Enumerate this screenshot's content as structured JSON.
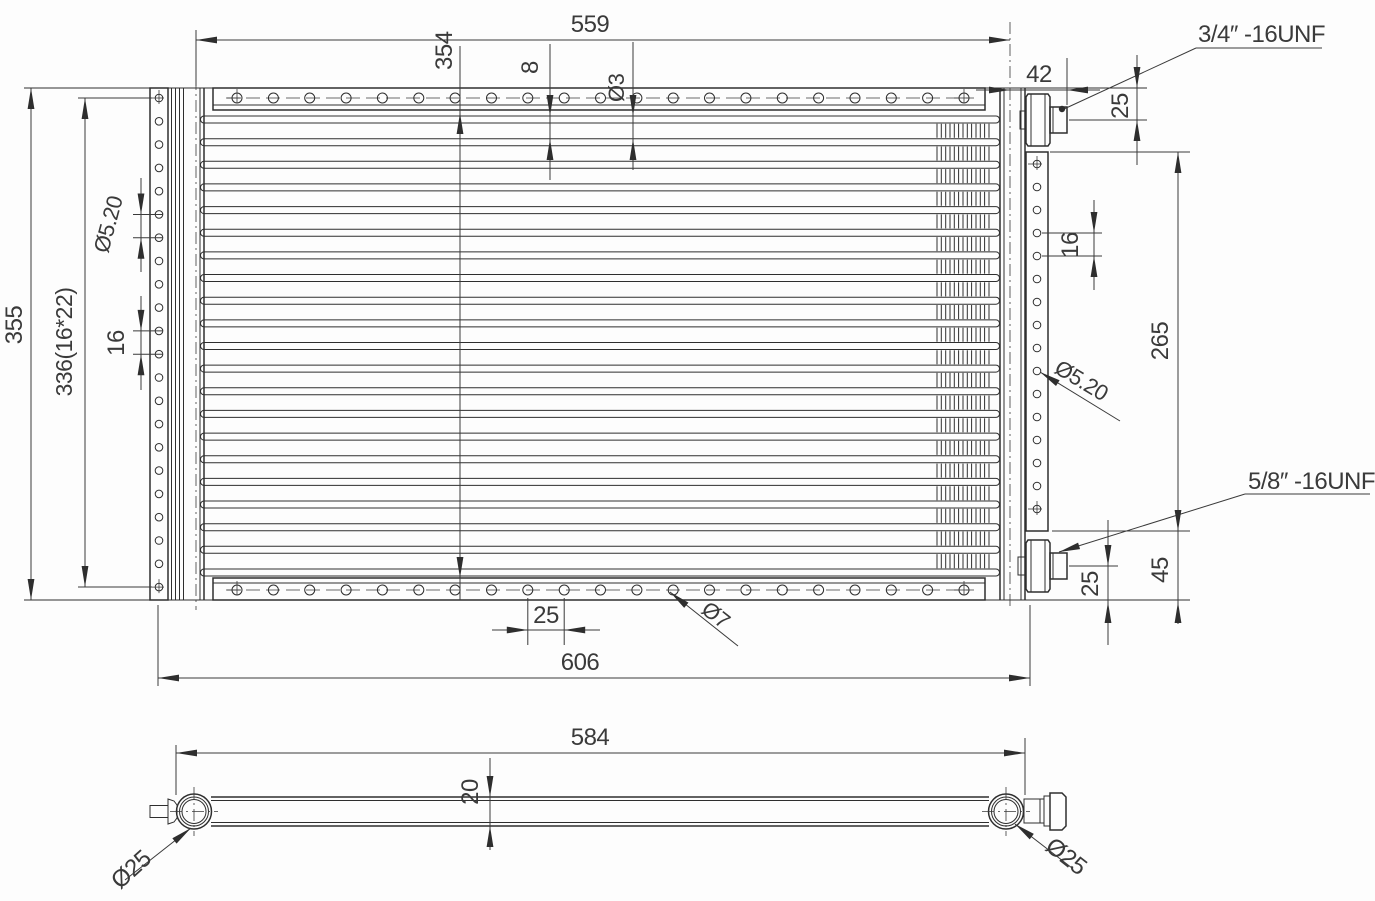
{
  "colors": {
    "background": "#fdfdfd",
    "line": "#2e2e2e",
    "dim_line": "#3a3a3a"
  },
  "front_view": {
    "dims": {
      "width_top": "559",
      "core_height": "354",
      "fin_pitch": "8",
      "tube_dia": "Ø3",
      "fitting_offset": "42",
      "top_fitting_center": "25",
      "right_hole_pitch": "16",
      "right_bracket_span": "265",
      "right_hole_dia": "Ø5.20",
      "bracket_to_bottom": "45",
      "bottom_fitting_center": "25",
      "height_overall": "355",
      "left_hole_span": "336(16*22)",
      "left_hole_dia": "Ø5.20",
      "left_hole_pitch": "16",
      "bottom_hole_pitch": "25",
      "bottom_hole_dia": "Ø7",
      "width_overall": "606"
    },
    "labels": {
      "top_port_thread": "3/4″ -16UNF",
      "bottom_port_thread": "5/8″ -16UNF"
    },
    "geometry": {
      "left_bracket_holes": 22,
      "right_bracket_holes": 16,
      "plate_holes_per_row": 21,
      "tube_rows": 21
    }
  },
  "side_view": {
    "dims": {
      "length": "584",
      "thickness": "20",
      "left_port_dia": "Ø25",
      "right_port_dia": "Ø25"
    }
  }
}
